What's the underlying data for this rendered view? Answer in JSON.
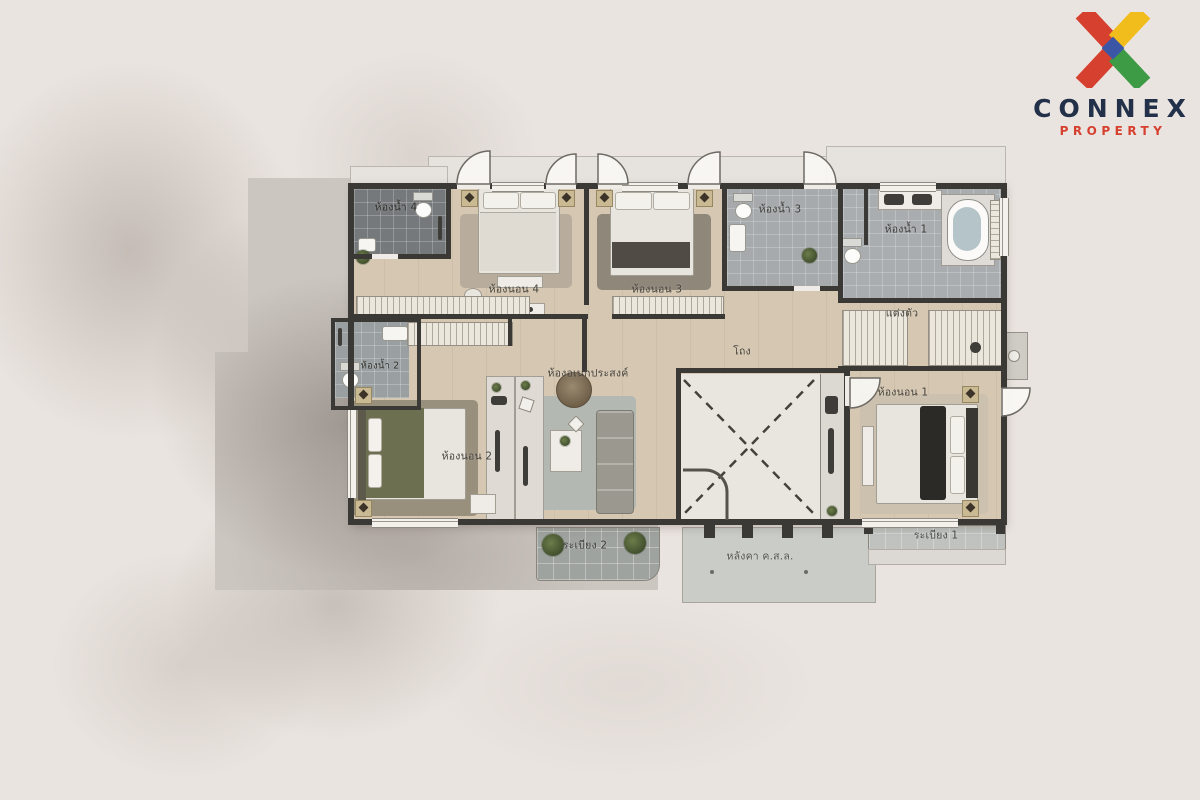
{
  "brand": {
    "name": "CONNEX",
    "tagline": "PROPERTY",
    "colors": {
      "x_red": "#d6402f",
      "x_yellow": "#f0bd1c",
      "x_green": "#3d9a45",
      "x_blue": "#3c56a6",
      "name_navy": "#233049",
      "tagline_red": "#d6402f"
    }
  },
  "floor_plan": {
    "rooms": [
      {
        "id": "bathroom-4",
        "label": "ห้องน้ำ 4"
      },
      {
        "id": "bedroom-4",
        "label": "ห้องนอน 4"
      },
      {
        "id": "bedroom-3",
        "label": "ห้องนอน 3"
      },
      {
        "id": "bathroom-3",
        "label": "ห้องน้ำ 3"
      },
      {
        "id": "bathroom-1",
        "label": "ห้องน้ำ 1"
      },
      {
        "id": "dressing",
        "label": "แต่งตัว"
      },
      {
        "id": "bathroom-2",
        "label": "ห้องน้ำ 2"
      },
      {
        "id": "bedroom-2",
        "label": "ห้องนอน 2"
      },
      {
        "id": "multipurpose",
        "label": "ห้องอเนกประสงค์"
      },
      {
        "id": "hall",
        "label": "โถง"
      },
      {
        "id": "bedroom-1",
        "label": "ห้องนอน 1"
      },
      {
        "id": "balcony-2",
        "label": "ระเบียง 2"
      },
      {
        "id": "rc-roof",
        "label": "หลังคา ค.ส.ล."
      },
      {
        "id": "balcony-1",
        "label": "ระเบียง 1"
      }
    ]
  }
}
